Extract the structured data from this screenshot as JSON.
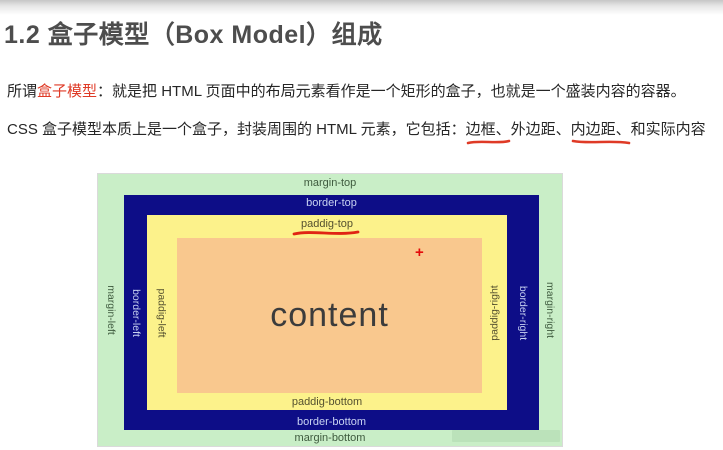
{
  "page": {
    "heading": "1.2 盒子模型（Box Model）组成",
    "para1": {
      "prefix": "所谓",
      "highlight": "盒子模型",
      "rest": "：就是把 HTML 页面中的布局元素看作是一个矩形的盒子，也就是一个盛装内容的容器。"
    },
    "para2": {
      "prefix": "CSS 盒子模型本质上是一个盒子，封装周围的 HTML 元素，它包括：",
      "underlined1": "边框、",
      "middle": "外边距、",
      "underlined2": "内边距、",
      "suffix": "和实际内容"
    }
  },
  "diagram": {
    "labels": {
      "margin_top": "margin-top",
      "border_top": "border-top",
      "padding_top": "paddig-top",
      "margin_bottom": "margin-bottom",
      "border_bottom": "border-bottom",
      "padding_bottom": "paddig-bottom",
      "margin_left": "margin-left",
      "border_left": "border-left",
      "padding_left": "paddig-left",
      "margin_right": "margin-right",
      "border_right": "border-right",
      "padding_right": "paddig-right",
      "content": "content",
      "plus_mark": "+"
    },
    "colors": {
      "margin_bg": "#c9eec7",
      "border_bg": "#0d0d87",
      "padding_bg": "#fcf28b",
      "content_bg": "#f9c88e",
      "annotation_red": "#df3a26"
    }
  }
}
